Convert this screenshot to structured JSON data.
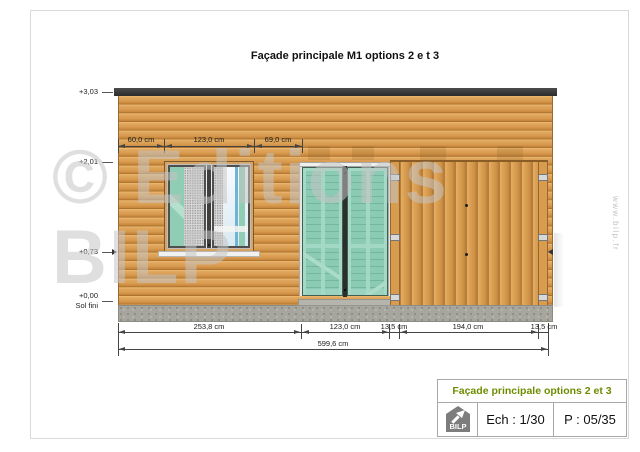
{
  "drawing": {
    "title": "Façade principale M1 options 2 e t 3"
  },
  "elevations": {
    "e303": "+3,03",
    "e201": "+2,01",
    "e073": "+0,73",
    "e000": "+0,00",
    "e000_sub": "Sol fini"
  },
  "dims": {
    "top": [
      "60,0 cm",
      "123,0 cm",
      "69,0 cm"
    ],
    "bottom": [
      "253,8 cm",
      "123,0 cm",
      "13,5 cm",
      "194,0 cm",
      "13,5 cm"
    ],
    "total": "599,6 cm"
  },
  "watermark": {
    "line1": "© Editions",
    "line2": "BILP",
    "url": "www.bilp.fr"
  },
  "title_block": {
    "title": "Façade principale options 2 et 3",
    "title_color": "#6f8c00",
    "logo": "BILP",
    "scale": "Ech : 1/30",
    "page": "P : 05/35"
  },
  "colors": {
    "roof": "#3a3a3a",
    "wood_siding": "#d79a4e",
    "garage_planks": "#cf9348",
    "door_glass": "#8ccbb3",
    "window_shutter": "#8fcdb4",
    "concrete": "#a7a69e",
    "dimension_lines": "#444444"
  }
}
